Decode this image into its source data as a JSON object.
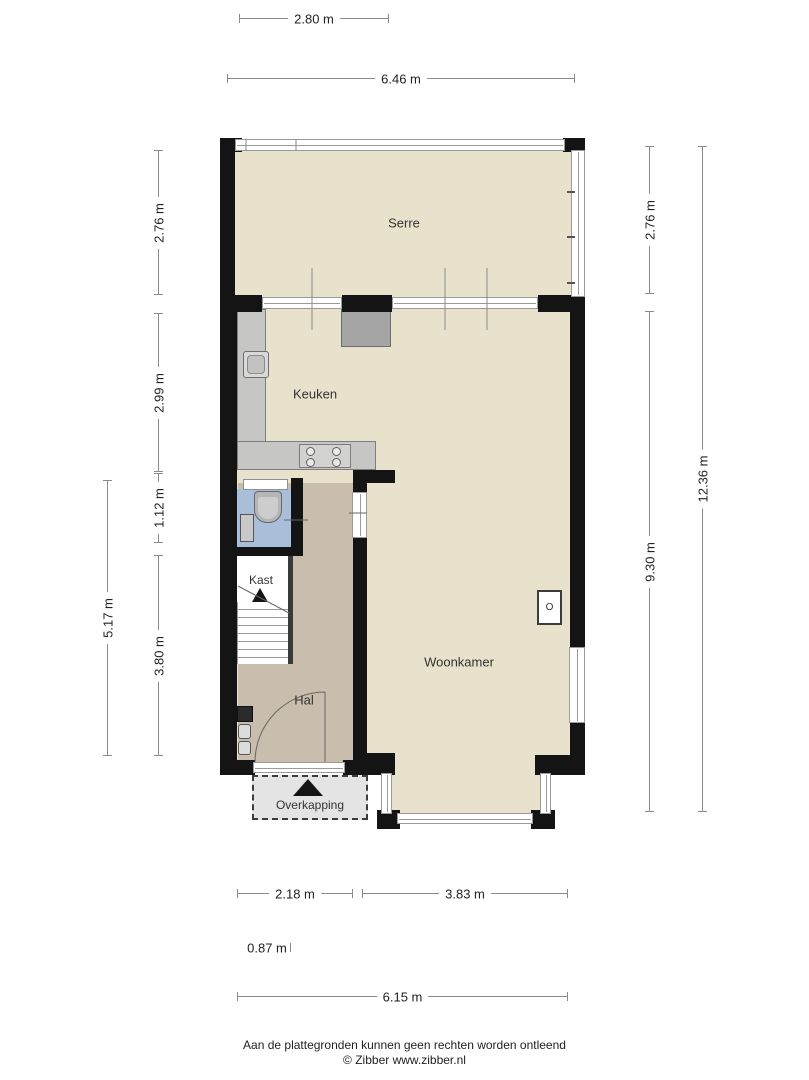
{
  "plan_type": "floor-plan",
  "rooms": {
    "serre": "Serre",
    "keuken": "Keuken",
    "woonkamer": "Woonkamer",
    "kast": "Kast",
    "hal": "Hal",
    "overkapping": "Overkapping"
  },
  "symbols": {
    "stove_marker": "O"
  },
  "dimensions": {
    "top": [
      "2.80 m",
      "6.46 m"
    ],
    "left": [
      "2.76 m",
      "2.99 m",
      "1.12 m",
      "5.17 m",
      "3.80 m"
    ],
    "right": [
      "2.76 m",
      "9.30 m",
      "12.36 m"
    ],
    "bottom": [
      "2.18 m",
      "3.83 m",
      "0.87 m",
      "6.15 m"
    ]
  },
  "footer": {
    "disclaimer": "Aan de plattegronden kunnen geen rechten worden ontleend",
    "credit": "© Zibber www.zibber.nl"
  },
  "colors": {
    "wall": "#141414",
    "floor_main": "#e8e1cb",
    "floor_hall": "#c9bead",
    "floor_toilet": "#a9bed9",
    "counter": "#c6c6c4",
    "overkapping_fill": "#e4e4e4",
    "dimension_line": "#8a8a8a"
  }
}
